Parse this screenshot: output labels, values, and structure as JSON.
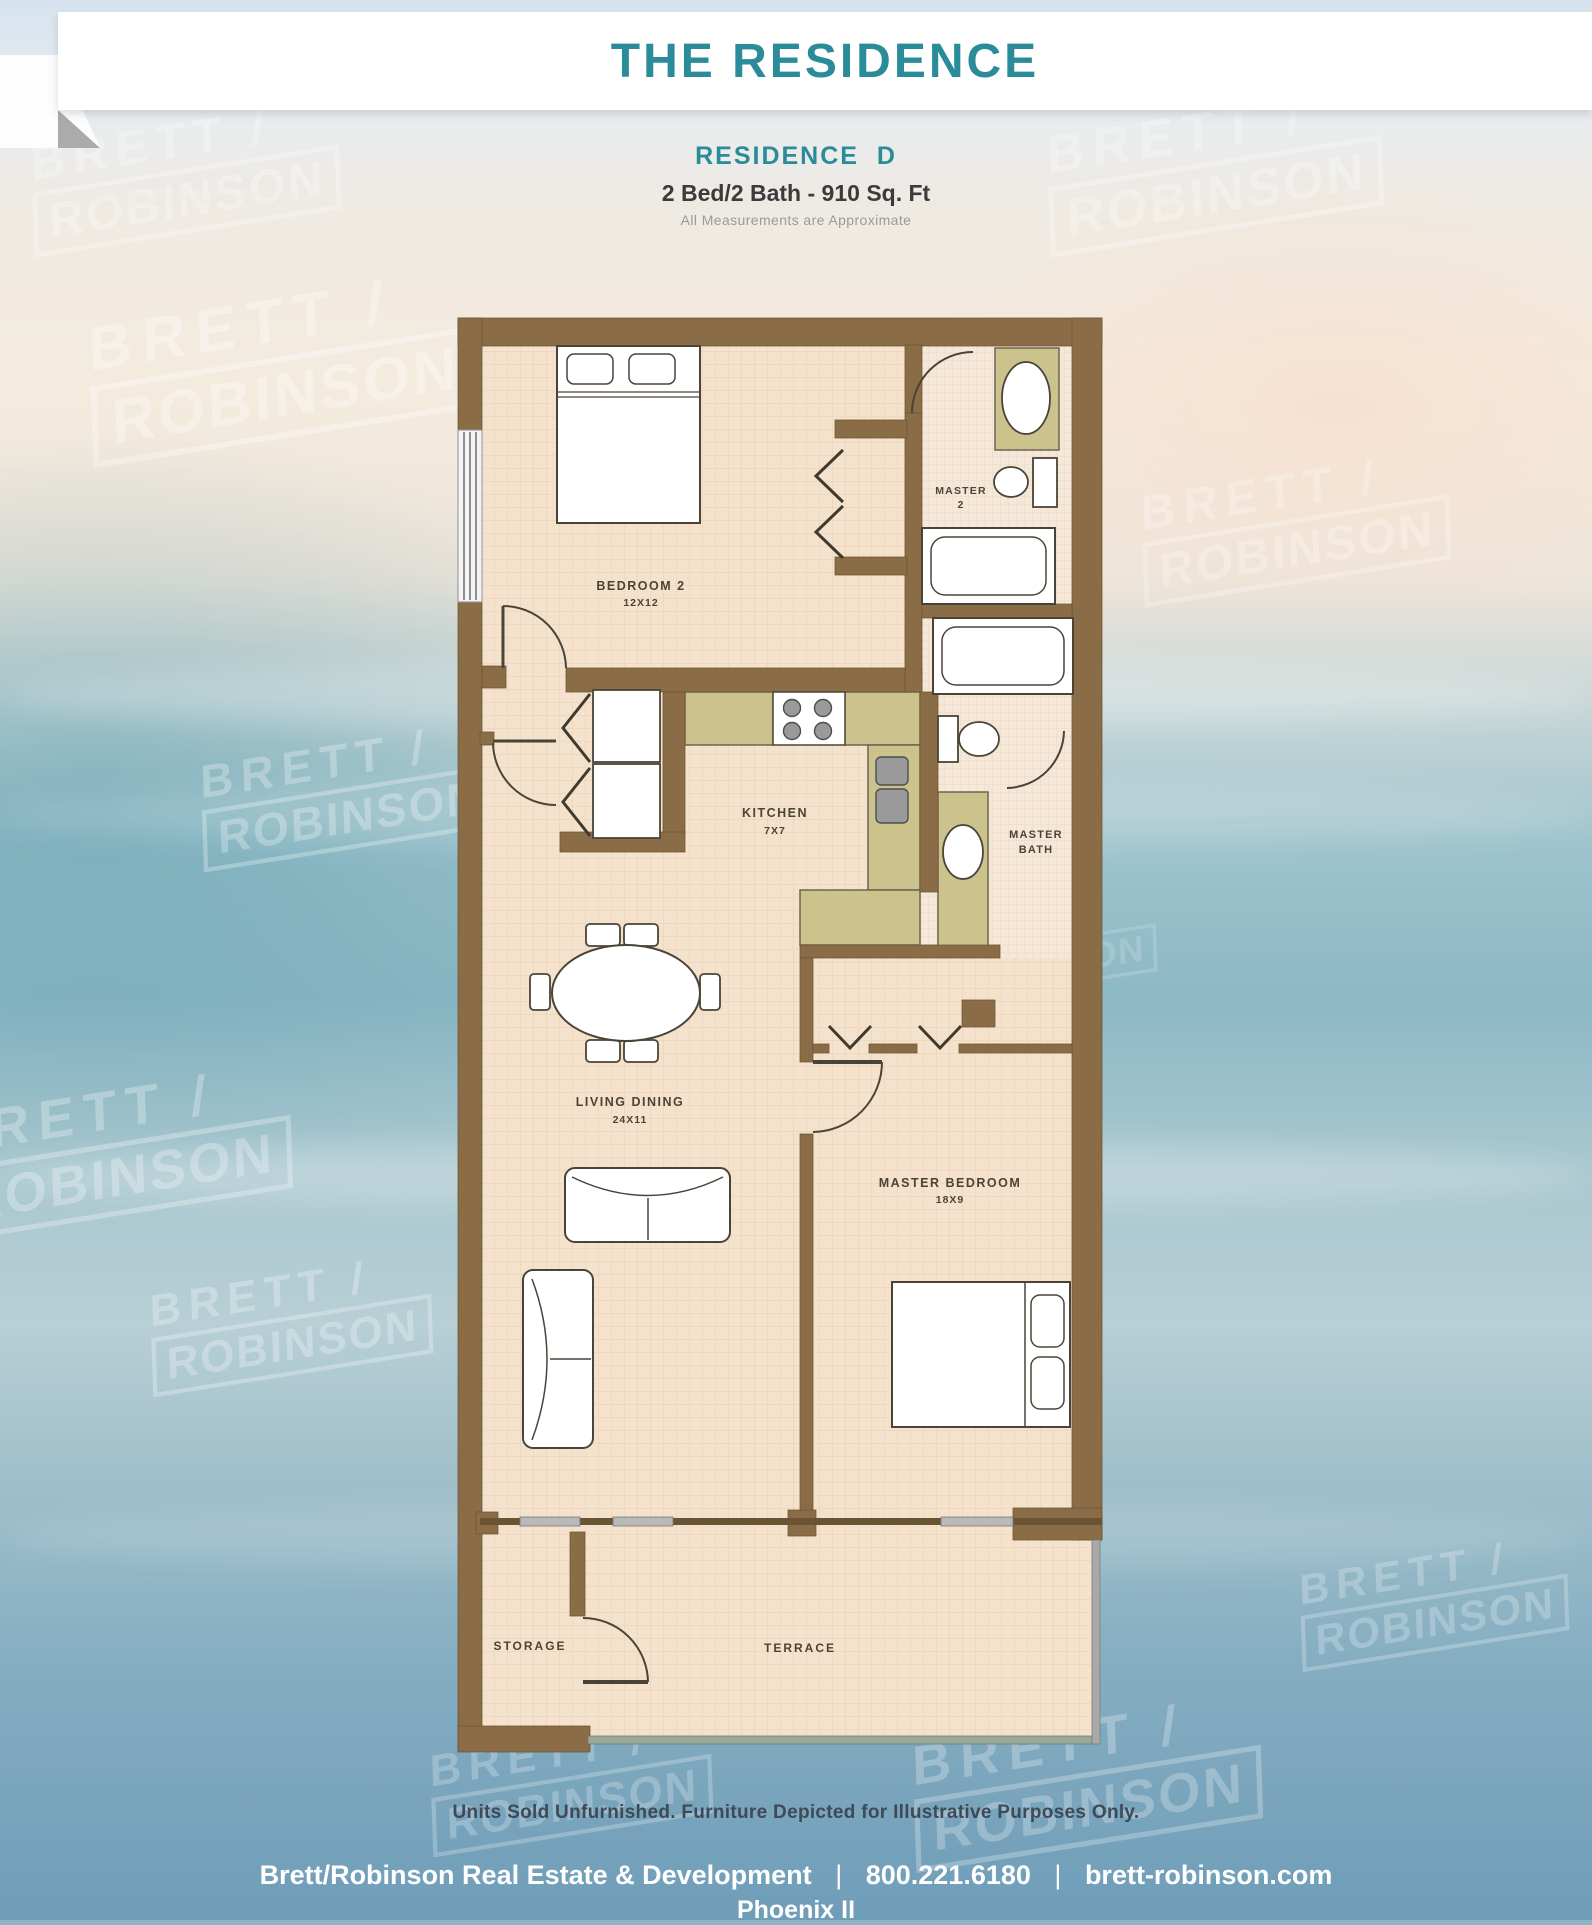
{
  "banner": {
    "title": "THE RESIDENCE"
  },
  "plan_header": {
    "residence_name": "RESIDENCE  D",
    "specs": "2 Bed/2 Bath - 910 Sq. Ft",
    "note": "All Measurements are Approximate"
  },
  "watermark": {
    "line1": "BRETT /",
    "line2": "ROBINSON"
  },
  "floor_plan": {
    "bedroom2": {
      "name": "BEDROOM 2",
      "dims": "12X12"
    },
    "master2_bath": {
      "line1": "MASTER",
      "line2": "2"
    },
    "kitchen": {
      "name": "KITCHEN",
      "dims": "7X7"
    },
    "master_bath": {
      "line1": "MASTER",
      "line2": "BATH"
    },
    "living_dining": {
      "name": "LIVING DINING",
      "dims": "24X11"
    },
    "master_bedroom": {
      "name": "MASTER BEDROOM",
      "dims": "18X9"
    },
    "storage": {
      "name": "STORAGE"
    },
    "terrace": {
      "name": "TERRACE"
    }
  },
  "footer": {
    "disclaimer": "Units Sold Unfurnished. Furniture Depicted for Illustrative Purposes Only.",
    "company": "Brett/Robinson Real Estate & Development",
    "phone": "800.221.6180",
    "website": "brett-robinson.com",
    "separator": "|",
    "building": "Phoenix II"
  },
  "colors": {
    "accent_teal": "#2b8c99",
    "wall_brown": "#8a6c46",
    "counter_khaki": "#cbc28c",
    "floor_beige": "#f4e2cd",
    "ocean_blue": "#84adc1"
  }
}
